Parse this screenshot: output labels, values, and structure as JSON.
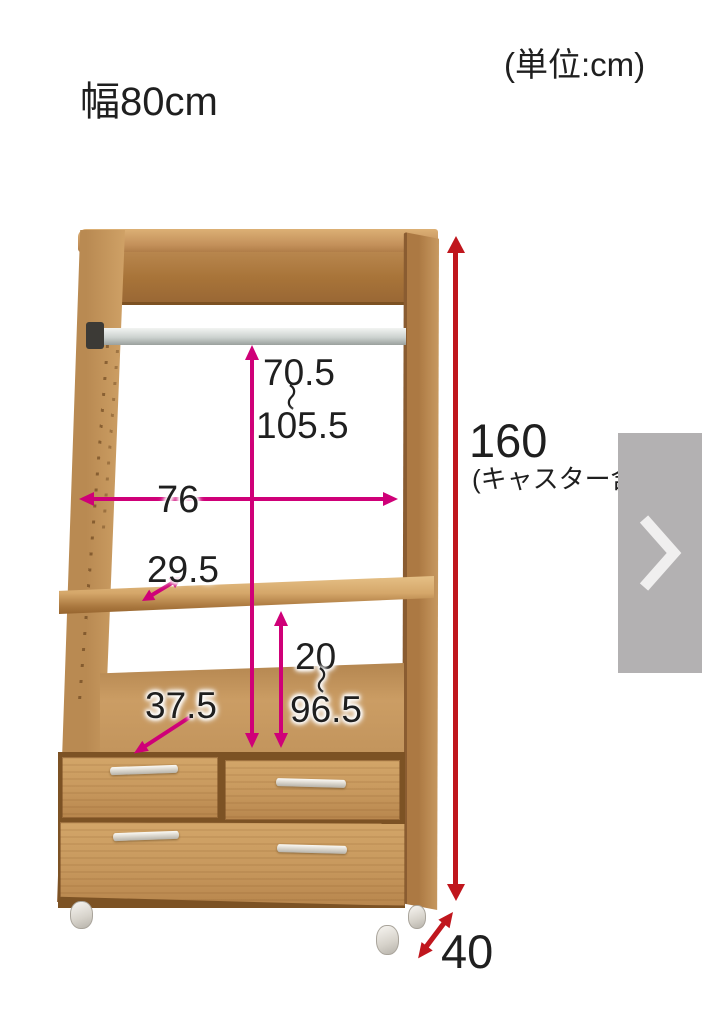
{
  "labels": {
    "width": "幅80cm",
    "unit": "(単位:cm)",
    "hanger_min": "70.5",
    "hanger_tilde": "〜",
    "hanger_max": "105.5",
    "inner_width": "76",
    "shelf_depth": "29.5",
    "lower_depth": "37.5",
    "lower_min": "20",
    "lower_tilde": "〜",
    "lower_max": "96.5",
    "total_height": "160",
    "total_height_note": "(キャスター含む)",
    "depth": "40"
  },
  "colors": {
    "dimension_magenta": "#cf0078",
    "dimension_red": "#c0161d",
    "wood": "#c79a61",
    "next_button_gray": "#b3b1b2",
    "text": "#1f1f1f"
  },
  "carousel": {
    "next_icon": "chevron-right"
  }
}
